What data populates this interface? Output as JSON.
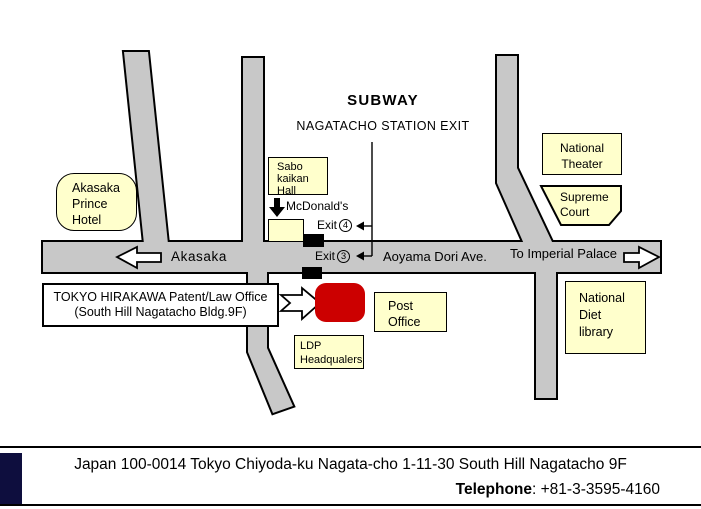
{
  "colors": {
    "road": "#c8c8c8",
    "label_bg": "#ffffcc",
    "building_red": "#cc0000",
    "footer_accent": "#0e0e3e"
  },
  "subway": {
    "title": "SUBWAY",
    "subtitle": "NAGATACHO STATION EXIT"
  },
  "places": {
    "akasaka_prince_hotel": "Akasaka\nPrince\nHotel",
    "sabo_kaikan_hall": "Sabo\nkaikan\nHall",
    "mcdonalds": "McDonald's",
    "national_theater": "National\nTheater",
    "supreme_court": "Supreme\nCourt",
    "national_diet_library": "National\nDiet\nlibrary",
    "post_office": "Post\nOffice",
    "ldp_headquarters": "LDP\nHeadqualers"
  },
  "exits": {
    "exit4_label": "Exit",
    "exit4_number": "4",
    "exit3_label": "Exit",
    "exit3_number": "3"
  },
  "roads": {
    "akasaka": "Akasaka",
    "aoyama_dori": "Aoyama Dori Ave.",
    "to_imperial_palace": "To Imperial Palace"
  },
  "office": {
    "line1": "TOKYO HIRAKAWA Patent/Law Office",
    "line2": "(South Hill Nagatacho Bldg.9F)"
  },
  "footer": {
    "address": "Japan 100-0014 Tokyo Chiyoda-ku Nagata-cho 1-11-30 South Hill Nagatacho 9F",
    "telephone_label": "Telephone",
    "telephone_number": ": +81-3-3595-4160"
  }
}
